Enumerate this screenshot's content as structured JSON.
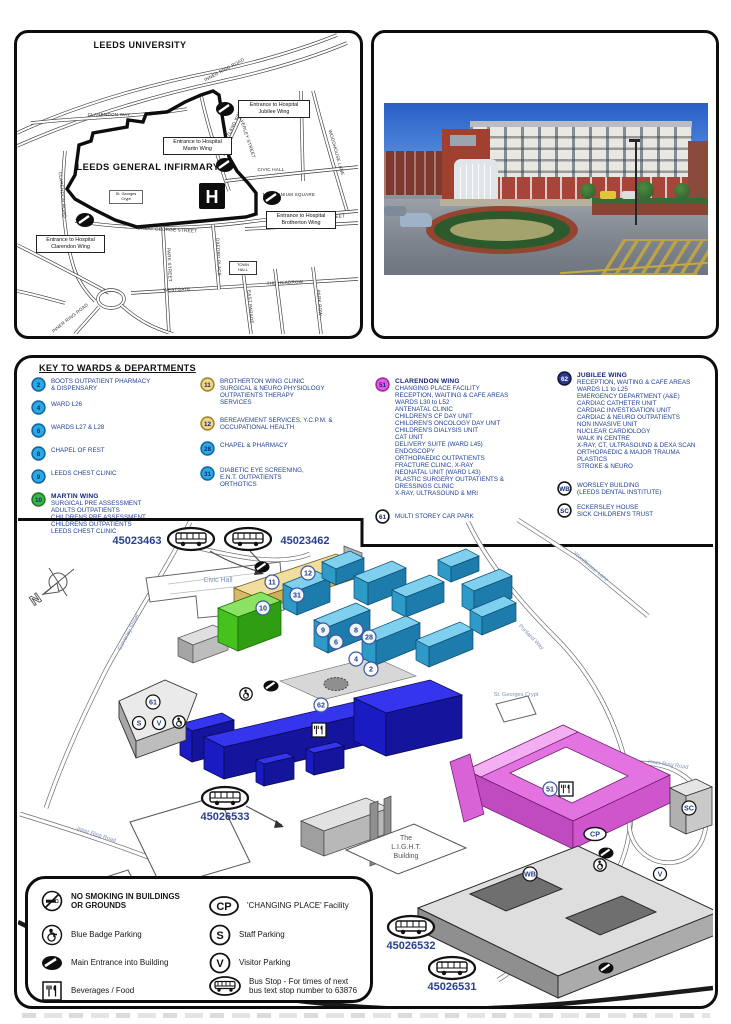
{
  "street_map": {
    "university": "LEEDS UNIVERSITY",
    "infirmary": "LEEDS GENERAL INFIRMARY",
    "h": "H",
    "ent_jubilee": "Entrance to Hospital\nJubilee Wing",
    "ent_martin": "Entrance to Hospital\nMartin Wing",
    "ent_brotherton": "Entrance to Hospital\nBrotherton Wing",
    "ent_clarendon": "Entrance to Hospital\nClarendon Wing",
    "town_hall": "TOWN\nHALL",
    "crypt": "St. Georges\nCrypt",
    "streets": {
      "inner_ring_top": "INNER RING ROAD",
      "clarendon_way": "CLARENDON WAY",
      "clarendon_road": "CLARENDON ROAD",
      "calverley": "CALVERLEY STREET",
      "portland": "PORTLAND WAY",
      "woodhouse": "WOODHOUSE LANE",
      "civic_hall": "CIVIC HALL",
      "millennium": "MILLENNIUM SQUARE",
      "gg_w": "GREAT GEORGE STREET",
      "gg_e": "GREAT GEORGE STREET",
      "park_street": "PARK STREET",
      "oxford_place": "OXFORD PLACE",
      "westgate": "WESTGATE",
      "headrow": "THE HEADROW",
      "east_parade": "EAST PARADE",
      "park_row": "PARK ROW",
      "inner_ring_bl": "INNER RING ROAD"
    }
  },
  "key": {
    "title": "KEY TO WARDS & DEPARTMENTS",
    "entries": [
      {
        "num": "2",
        "fill": "#29abe2",
        "ring": "#1464a5",
        "num_color": "#12267a",
        "text": "BOOTS OUTPATIENT PHARMACY\n& DISPENSARY"
      },
      {
        "num": "4",
        "fill": "#29abe2",
        "ring": "#1464a5",
        "num_color": "#12267a",
        "text": "WARD L26"
      },
      {
        "num": "6",
        "fill": "#29abe2",
        "ring": "#1464a5",
        "num_color": "#12267a",
        "text": "WARDS L27 & L28"
      },
      {
        "num": "8",
        "fill": "#29abe2",
        "ring": "#1464a5",
        "num_color": "#12267a",
        "text": "CHAPEL OF REST"
      },
      {
        "num": "9",
        "fill": "#29abe2",
        "ring": "#1464a5",
        "num_color": "#12267a",
        "text": "LEEDS CHEST CLINIC"
      },
      {
        "num": "10",
        "fill": "#3db54a",
        "ring": "#1f7a1f",
        "num_color": "#12267a",
        "title": "MARTIN WING",
        "text": "SURGICAL PRE ASSESSMENT\nADULTS OUTPATIENTS\nCHILDRENS PRE ASSESSMENT\nCHILDRENS OUTPATIENTS\nLEEDS CHEST CLINIC"
      },
      {
        "num": "11",
        "fill": "#f2d588",
        "ring": "#a08828",
        "num_color": "#12267a",
        "text": "BROTHERTON WING CLINIC\nSURGICAL & NEURO PHYSIOLOGY\nOUTPATIENTS THERAPY\nSERVICES"
      },
      {
        "num": "12",
        "fill": "#f2d588",
        "ring": "#a08828",
        "num_color": "#12267a",
        "text": "BEREAVEMENT SERVICES, Y.C.P.M. &\nOCCUPATIONAL HEALTH"
      },
      {
        "num": "28",
        "fill": "#29abe2",
        "ring": "#1464a5",
        "num_color": "#12267a",
        "text": "CHAPEL & PHARMACY"
      },
      {
        "num": "31",
        "fill": "#29abe2",
        "ring": "#1464a5",
        "num_color": "#12267a",
        "text": "DIABETIC EYE SCREENING,\nE.N.T. OUTPATIENTS\nORTHOTICS"
      },
      {
        "num": "51",
        "fill": "#e55ce2",
        "ring": "#a02ba0",
        "num_color": "#12267a",
        "title": "CLARENDON WING",
        "text": "CHANGING PLACE FACILITY\nRECEPTION, WAITING & CAFE AREAS\nWARDS L30 to L52\nANTENATAL CLINIC\nCHILDREN'S CF DAY UNIT\nCHILDREN'S ONCOLOGY DAY UNIT\nCHILDREN'S DIALYSIS UNIT\nCAT UNIT\nDELIVERY SUITE (WARD L45)\nENDOSCOPY\nORTHOPAEDIC OUTPATIENTS\nFRACTURE CLINIC, X-RAY\nNEONATAL UNIT (WARD L43)\nPLASTIC SURGERY OUTPATIENTS &\nDRESSINGS CLINIC\nX-RAY, ULTRASOUND & MRI"
      },
      {
        "num": "61",
        "fill": "#ffffff",
        "ring": "#111111",
        "num_color": "#12267a",
        "text": "MULTI STOREY CAR PARK"
      },
      {
        "num": "62",
        "fill": "#2b3990",
        "ring": "#10163f",
        "num_color": "#ffffff",
        "title": "JUBILEE WING",
        "text": "RECEPTION, WAITING & CAFE AREAS\nWARDS L1 to L25\nEMERGENCY DEPARTMENT (A&E)\nCARDIAC CATHETER UNIT\nCARDIAC INVESTIGATION UNIT\nCARDIAC & NEURO OUTPATIENTS\nNON INVASIVE UNIT\nNUCLEAR CARDIOLOGY\nWALK IN CENTRE\nX-RAY, CT, ULTRASOUND & DEXA SCAN\nORTHOPAEDIC & MAJOR TRAUMA\nPLASTICS\nSTROKE & NEURO"
      },
      {
        "num": "WB",
        "fill": "#ffffff",
        "ring": "#111111",
        "num_color": "#12267a",
        "text": "WORSLEY BUILDING\n(LEEDS DENTAL INSTITUTE)"
      },
      {
        "num": "SC",
        "fill": "#ffffff",
        "ring": "#111111",
        "num_color": "#12267a",
        "text": "ECKERSLEY HOUSE\nSICK CHILDREN'S TRUST"
      }
    ]
  },
  "campus": {
    "civic_hall": "Civic Hall",
    "crypt": "St. Georges Crypt",
    "light1": "The",
    "light2": "L.I.G.H.T.",
    "light3": "Building",
    "compass_n": "N",
    "streets": {
      "calverley": "Calverley Street",
      "inner_ring": "Inner Ring Road",
      "inner_ring2": "Inner Ring Road",
      "portland": "Portland Way",
      "woodhouse": "Woodhouse Lane",
      "great_george": "Great George Street"
    },
    "bus": {
      "b1": "45023463",
      "b2": "45023462",
      "b3": "45026533",
      "b4": "45026532",
      "b5": "45026531"
    },
    "badges": {
      "n2": "2",
      "n4": "4",
      "n6": "6",
      "n8": "8",
      "n9": "9",
      "n10": "10",
      "n11": "11",
      "n12": "12",
      "n28": "28",
      "n31": "31",
      "n51": "51",
      "n61": "61",
      "n62": "62",
      "wb": "WB",
      "sc": "SC",
      "cp": "CP",
      "s": "S",
      "v": "V",
      "v2": "V"
    }
  },
  "legend": {
    "no_smoking": "NO SMOKING IN BUILDINGS\nOR GROUNDS",
    "blue_badge": "Blue Badge Parking",
    "main_entrance": "Main Entrance into Building",
    "beverages": "Beverages / Food",
    "changing_place": "'CHANGING PLACE' Facility",
    "staff": "Staff Parking",
    "visitor": "Visitor Parking",
    "bus_stop": "Bus Stop - For times of next\nbus text stop number to 63876",
    "cp": "CP",
    "s": "S",
    "v": "V"
  },
  "colors": {
    "cyan": "#29abe2",
    "green": "#3db54a",
    "tan": "#f2d588",
    "magenta": "#e55ce2",
    "royal_blue": "#2424cf",
    "navy_text": "#1e3f96",
    "dark_blue": "#2b3990"
  }
}
